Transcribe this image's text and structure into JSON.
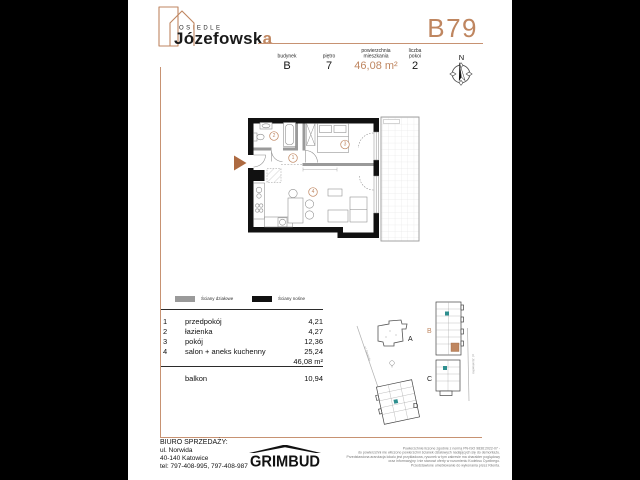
{
  "colors": {
    "accent": "#bf8660",
    "entrance_arrow": "#ad6a41",
    "partition_wall": "#9a9a9a",
    "bearing_wall": "#111111",
    "site_marker_teal": "#2e8f8f"
  },
  "header": {
    "logo": {
      "line1_pre": "OS",
      "line1_accent": "I",
      "line1_post": "EDLE",
      "line2_main": "Józefowsk",
      "line2_accent": "a"
    },
    "unit_code": "B79",
    "info": [
      {
        "label": "budynek",
        "value": "B"
      },
      {
        "label": "piętro",
        "value": "7"
      },
      {
        "label": "powierzchnia mieszkania",
        "value": "46,08 m²"
      },
      {
        "label": "liczba pokoi",
        "value": "2"
      }
    ],
    "compass_north": "N"
  },
  "plan": {
    "room_markers": [
      "1",
      "2",
      "3",
      "4"
    ]
  },
  "legend": {
    "partition": "Ściany działowe",
    "bearing": "Ściany nośne"
  },
  "area_table": {
    "rows": [
      {
        "no": "1",
        "name": "przedpokój",
        "area": "4,21"
      },
      {
        "no": "2",
        "name": "łazienka",
        "area": "4,27"
      },
      {
        "no": "3",
        "name": "pokój",
        "area": "12,36"
      },
      {
        "no": "4",
        "name": "salon + aneks kuchenny",
        "area": "25,24"
      }
    ],
    "total": "46,08 m²",
    "balcony_name": "balkon",
    "balcony_area": "10,94"
  },
  "site_plan": {
    "buildings": [
      "A",
      "B",
      "C",
      "D"
    ],
    "street_left": "ul. Norwida",
    "street_right": "ul. Józefowska"
  },
  "footer": {
    "office_title": "BIURO SPRZEDAŻY:",
    "office_lines": [
      "ul. Norwida",
      "40-140 Katowice",
      "tel: 797-408-995, 797-408-987"
    ],
    "builder": "GRIMBUD",
    "disclaimer": [
      "Powierzchnie liczone zgodnie z normą PN-ISO 9836:2022-07 -",
      "do powierzchni nie wliczono powierzchni ścianek działowych nadających się do demontażu.",
      "Przedstawiona aranżacja lokalu jest przykładowa, rysunek w tym zakresie ma charakter poglądowy",
      "oraz informacyjny i nie stanowi oferty w rozumieniu Kodeksu Cywilnego.",
      "Przedstawione umeblowanie do wykonania przez Klienta."
    ]
  }
}
